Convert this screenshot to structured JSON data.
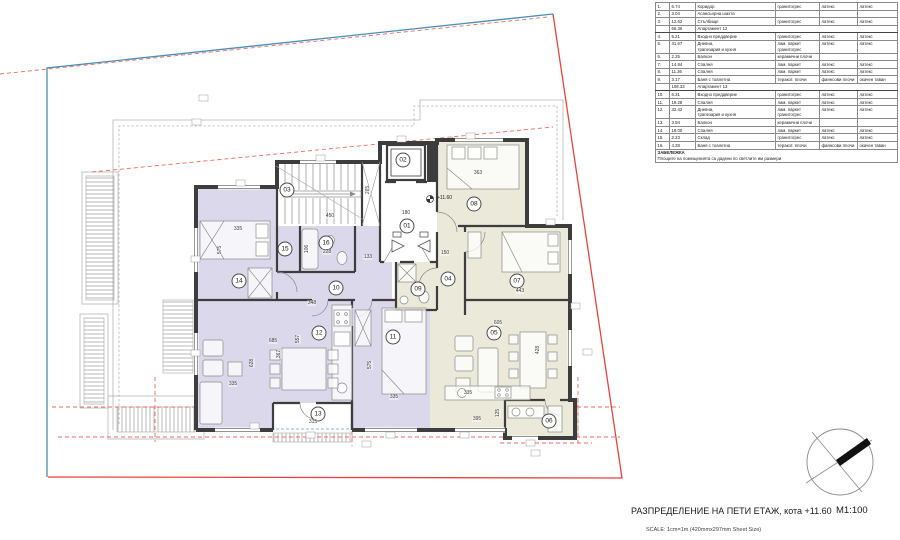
{
  "title_block": {
    "title": "РАЗПРЕДЕЛЕНИЕ НА ПЕТИ ЕТАЖ, кота +11.60",
    "scale": "М1:100",
    "scale_note": "SCALE: 1cm=1m (420mmx297mm Sheet Size)"
  },
  "plan": {
    "level_mark": "+11.60",
    "room_labels": [
      "01",
      "02",
      "03",
      "04",
      "05",
      "06",
      "07",
      "08",
      "09",
      "10",
      "11",
      "12",
      "13",
      "14",
      "15",
      "16"
    ],
    "dimensions": [
      "335",
      "575",
      "450",
      "265",
      "180",
      "133",
      "228",
      "106",
      "363",
      "150",
      "443",
      "348",
      "685",
      "557",
      "367",
      "335",
      "628",
      "575",
      "335",
      "605",
      "428",
      "335",
      "395",
      "125",
      "315"
    ]
  },
  "room_table": {
    "rows": [
      {
        "n": "1.",
        "area": "6.74",
        "name": "Коридор",
        "floor": "гранитогрес",
        "walls": "латекс",
        "ceiling": "латекс"
      },
      {
        "n": "2.",
        "area": "3.04",
        "name": "Асансьорна шахта",
        "floor": "",
        "walls": "",
        "ceiling": ""
      },
      {
        "n": "3.",
        "area": "12.62",
        "name": "Стълбище",
        "floor": "гранитогрес",
        "walls": "латекс",
        "ceiling": "латекс"
      },
      {
        "summary": true,
        "area": "66.36",
        "name": "Апартамент 12"
      },
      {
        "n": "4.",
        "area": "5.21",
        "name": "Входно преддверие",
        "floor": "гранитогрес",
        "walls": "латекс",
        "ceiling": "латекс"
      },
      {
        "n": "5.",
        "area": "31.67",
        "name": "Дневна,\nтрапезария и кухня",
        "floor": "лам. паркет\nгранитогрес",
        "walls": "латекс",
        "ceiling": "латекс"
      },
      {
        "n": "6.",
        "area": "2.25",
        "name": "Балкон",
        "floor": "керамични плочи",
        "walls": "",
        "ceiling": ""
      },
      {
        "n": "7.",
        "area": "14.84",
        "name": "Спалня",
        "floor": "лам. паркет",
        "walls": "латекс",
        "ceiling": "латекс"
      },
      {
        "n": "8.",
        "area": "11.36",
        "name": "Спалня",
        "floor": "лам. паркет",
        "walls": "латекс",
        "ceiling": "латекс"
      },
      {
        "n": "9.",
        "area": "3.17",
        "name": "Баня с тоалетна",
        "floor": "теракот. плочи",
        "walls": "фаянсови плочи",
        "ceiling": "окачен таван"
      },
      {
        "summary": true,
        "area": "108.33",
        "name": "Апартамент 13"
      },
      {
        "n": "10.",
        "area": "6.31",
        "name": "Входно преддверие",
        "floor": "гранитогрес",
        "walls": "латекс",
        "ceiling": "латекс"
      },
      {
        "n": "11.",
        "area": "19.28",
        "name": "Спалня",
        "floor": "лам. паркет",
        "walls": "латекс",
        "ceiling": "латекс"
      },
      {
        "n": "12.",
        "area": "32.42",
        "name": "Дневна,\nтрапезария и кухня",
        "floor": "лам. паркет\nгранитогрес",
        "walls": "латекс",
        "ceiling": "латекс"
      },
      {
        "n": "13.",
        "area": "3.94",
        "name": "Балкон",
        "floor": "керамични плочи",
        "walls": "",
        "ceiling": ""
      },
      {
        "n": "14.",
        "area": "18.00",
        "name": "Спалня",
        "floor": "лам. паркет",
        "walls": "латекс",
        "ceiling": "латекс"
      },
      {
        "n": "15.",
        "area": "2.23",
        "name": "Склад",
        "floor": "гранитогрес",
        "walls": "латекс",
        "ceiling": "латекс"
      },
      {
        "n": "16.",
        "area": "4.28",
        "name": "Баня с тоалетна",
        "floor": "теракот. плочи",
        "walls": "фаянсови плочи",
        "ceiling": "окачен таван"
      }
    ],
    "note_title": "ЗАБЕЛЕЖКА",
    "note_text": "Площите на помещенията са дадени по светлите им размери"
  },
  "colors": {
    "apartment_12_fill": "#ebe9da",
    "apartment_13_fill": "#dcd8eb",
    "boundary_blue": "#4a8fb5",
    "boundary_red": "#e8443a",
    "dashed_red": "#ef6a60",
    "wall": "#3d3d3d"
  }
}
